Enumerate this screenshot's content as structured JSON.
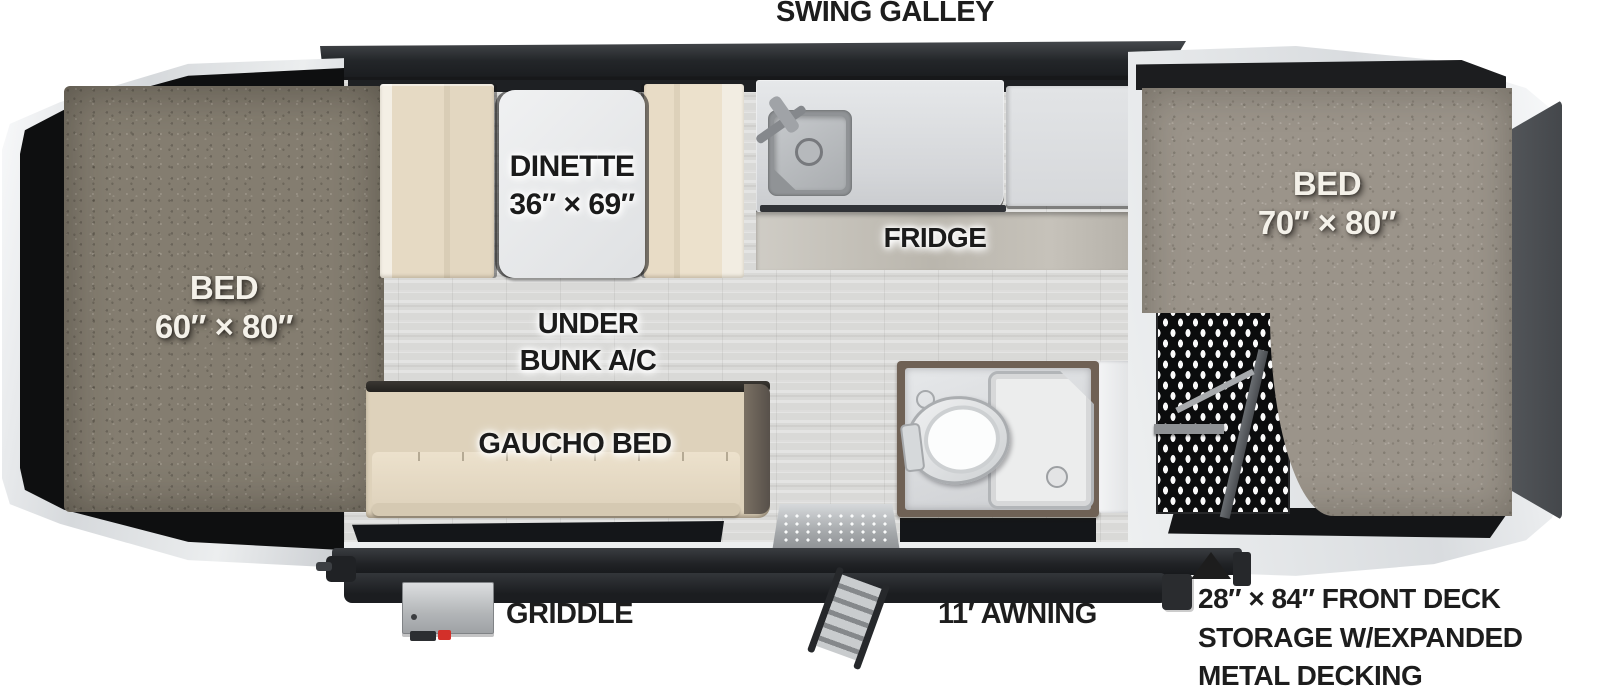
{
  "labels": {
    "swing_galley": "SWING GALLEY",
    "griddle": "GRIDDLE",
    "awning": "11′ AWNING"
  },
  "beds": {
    "left": {
      "name": "BED",
      "size": "60″ × 80″"
    },
    "right": {
      "name": "BED",
      "size": "70″ × 80″"
    }
  },
  "dinette": {
    "name": "DINETTE",
    "size": "36″ × 69″"
  },
  "fridge": {
    "label": "FRIDGE"
  },
  "under_bunk_ac": {
    "line1": "UNDER",
    "line2": "BUNK A/C"
  },
  "gaucho_bed": {
    "label": "GAUCHO BED"
  },
  "front_deck_note": {
    "line1": "28″ × 84″ FRONT DECK",
    "line2": "STORAGE W/EXPANDED",
    "line3": "METAL DECKING"
  },
  "colors": {
    "body_black": "#1a1c1e",
    "frame_white": "#eef0f1",
    "carpet_dark": "#847d70",
    "carpet_light": "#9b948a",
    "cushion_tan": "#e0d3bc",
    "counter_gray": "#d9dbdd",
    "floor_gray": "#d9d9d7",
    "bath_brown": "#6f6155",
    "griddle_red": "#d3302a",
    "label_black": "#1d1d1d"
  }
}
